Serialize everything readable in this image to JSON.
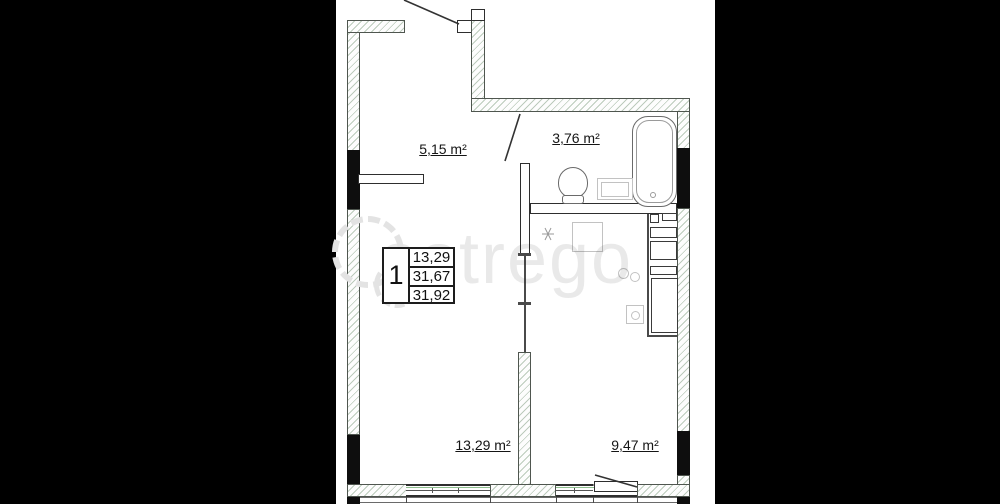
{
  "plan": {
    "type": "apartment-floor-plan",
    "rooms": {
      "hallway": {
        "label": "5,15 m²"
      },
      "bathroom": {
        "label": "3,76 m²"
      },
      "living": {
        "label": "13,29 m²"
      },
      "kitchen": {
        "label": "9,47 m²"
      }
    },
    "legend": {
      "unit_number": "1",
      "values": [
        "13,29",
        "31,67",
        "31,92"
      ]
    },
    "fixtures": [
      "entrance-door",
      "bathroom-door",
      "balcony-door",
      "bathtub",
      "toilet",
      "sink",
      "wardrobe",
      "kitchen-counter",
      "stove",
      "fridge",
      "window-living",
      "window-kitchen",
      "vent-symbol",
      "kitchen-table"
    ],
    "colors": {
      "letterbox": "#000000",
      "paper": "#ffffff",
      "wall_black": "#0e0e0e",
      "hatch_line": "#bccbbc",
      "line": "#2e2e2e",
      "green_accent": "#8fbf8f",
      "watermark": "#e3e3e3"
    }
  },
  "watermark": {
    "text": "astrego"
  }
}
